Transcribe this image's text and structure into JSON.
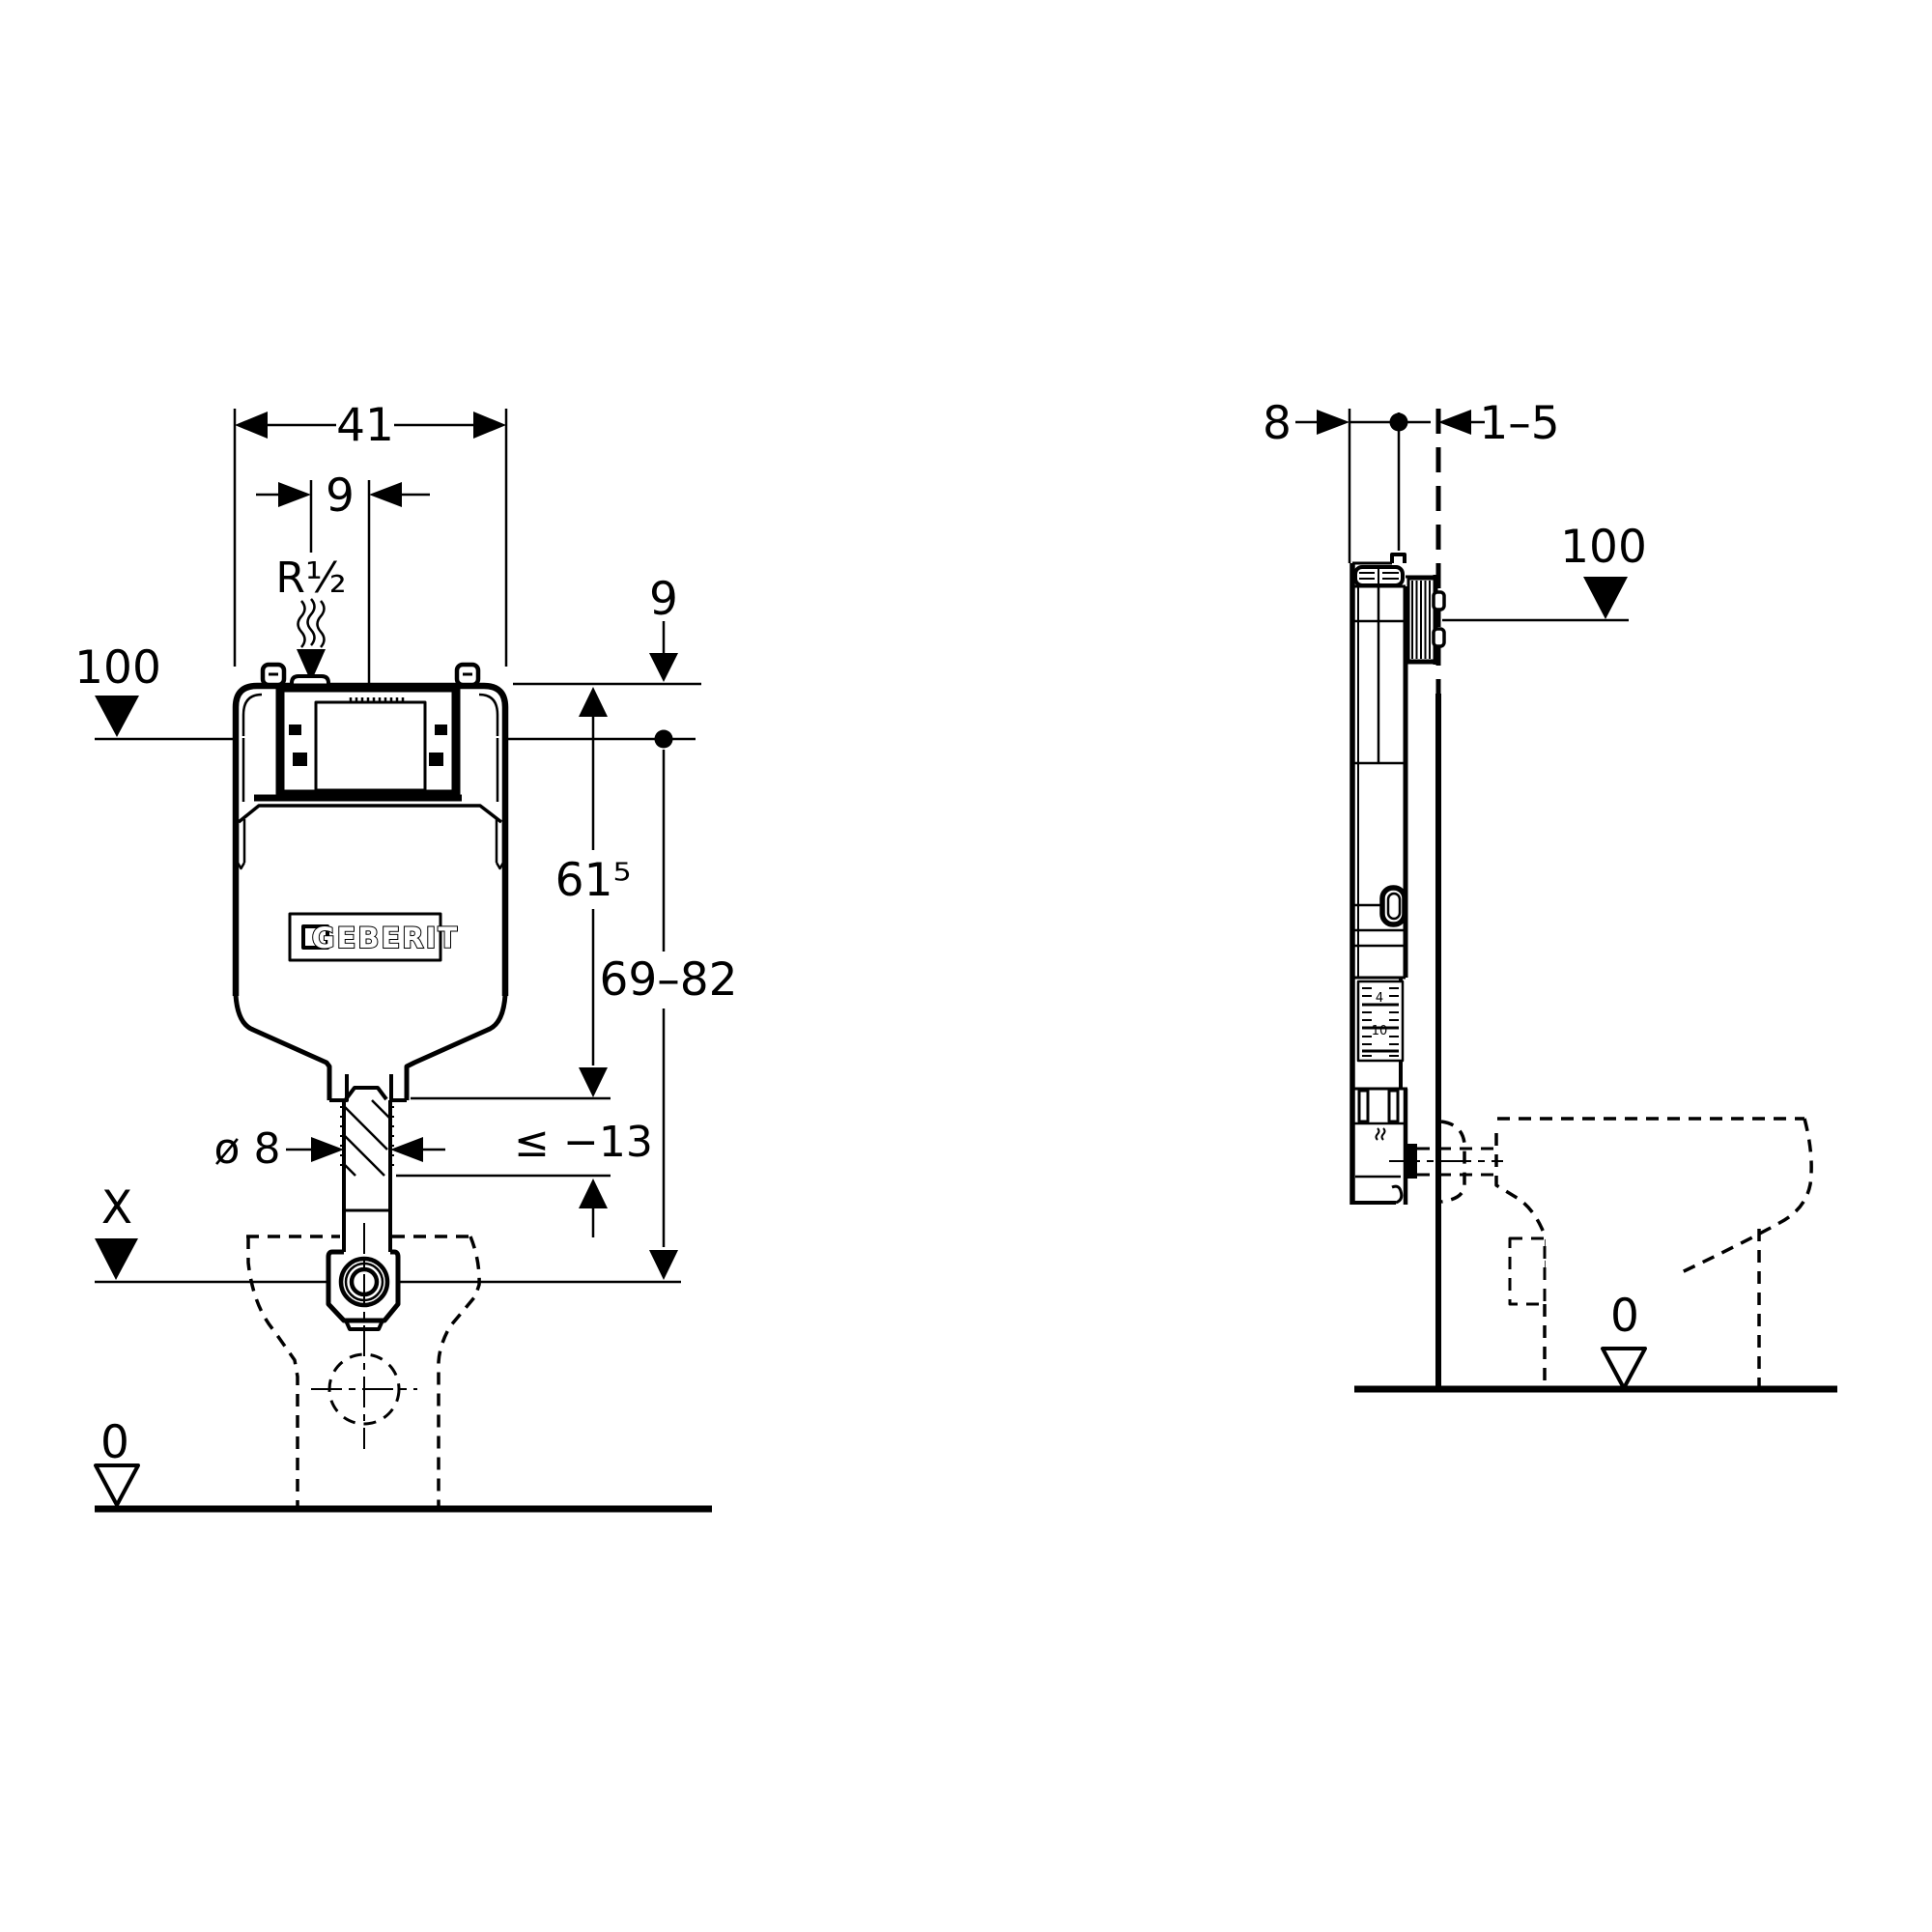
{
  "page": {
    "background": "#ffffff",
    "ink": "#000000"
  },
  "front_view": {
    "title": "concealed-cistern-front-elevation",
    "brand_label": "GEBERIT",
    "labels": {
      "width": "41",
      "supply_offset": "9",
      "supply_thread": "R½",
      "meter_datum": "100",
      "top_offset": "9",
      "body_height": "61⁵",
      "actuation_range": "69–82",
      "pipe_diameter": "ø 8",
      "cut_length": "≤ −13",
      "datum_x": "X",
      "datum_zero": "0"
    }
  },
  "side_view": {
    "title": "concealed-cistern-side-section",
    "labels": {
      "depth": "8",
      "finish_thickness": "1–5",
      "meter_datum": "100",
      "datum_zero": "0",
      "ruler_mark_a": "4",
      "ruler_mark_b": "10"
    }
  }
}
